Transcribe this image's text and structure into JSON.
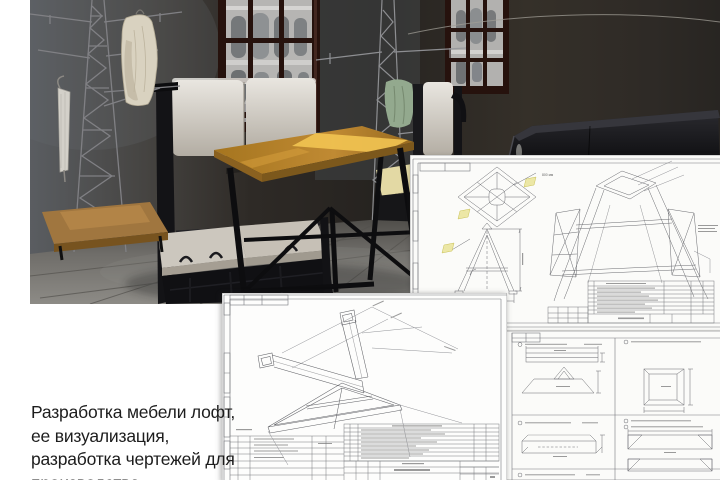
{
  "caption": {
    "line1": "Разработка мебели лофт,",
    "line2": "ее визуализация,",
    "line3": "разработка чертежей для",
    "line4": "производства",
    "color": "#1d1d1d"
  },
  "render": {
    "colors": {
      "wall_left": "#54575b",
      "wall_dark": "#2b2723",
      "floor": "#7b7a76",
      "window_frame": "#26120d",
      "window_view": "#b5b4b2",
      "cushion": "#d6d1c8",
      "seat_sunlit": "#e3d9a4",
      "table_wood": "#b5812f",
      "table_highlight": "#f2c452",
      "metal_frame": "#121215",
      "tower_metal": "#8b8c90",
      "cloth_green": "#93a98e",
      "coat_cream": "#d9d2c0",
      "base_wood": "#a0763f"
    }
  },
  "sheets": {
    "paper": "#fbfbf9",
    "line": "#6a6b70",
    "accent_yellow": "#ece7a6",
    "annotation_gray": "#9a9a9a",
    "dim_label": "800 мм"
  }
}
